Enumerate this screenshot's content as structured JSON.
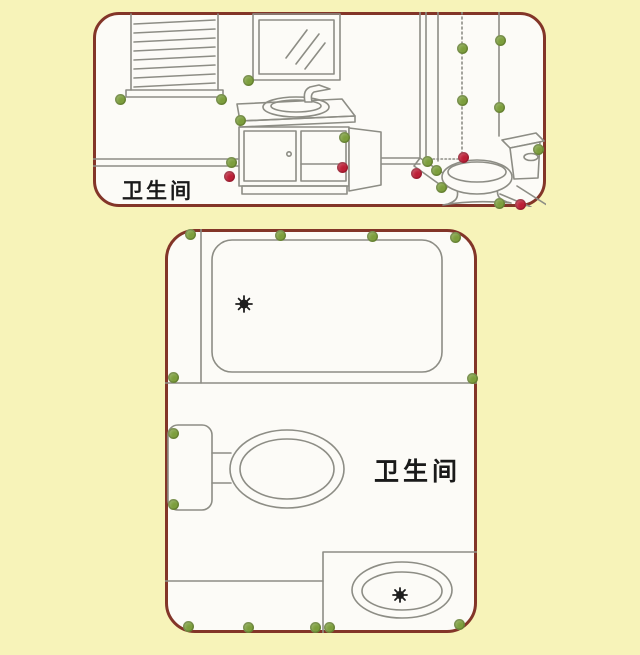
{
  "figure": {
    "background_color": "#F7F3B9",
    "panel_border_color": "#833528",
    "panel_fill_color": "#FCFBF7",
    "line_color": "#8D8D85",
    "point_colors": {
      "green": "#7C9E3C",
      "red": "#BC1F36"
    },
    "elevation": {
      "label": "卫生间",
      "points": [
        {
          "x": 27,
          "y": 87,
          "color": "green"
        },
        {
          "x": 128,
          "y": 87,
          "color": "green"
        },
        {
          "x": 155,
          "y": 68,
          "color": "green"
        },
        {
          "x": 147,
          "y": 108,
          "color": "green"
        },
        {
          "x": 138,
          "y": 150,
          "color": "green"
        },
        {
          "x": 251,
          "y": 125,
          "color": "green"
        },
        {
          "x": 369,
          "y": 36,
          "color": "green"
        },
        {
          "x": 407,
          "y": 28,
          "color": "green"
        },
        {
          "x": 369,
          "y": 88,
          "color": "green"
        },
        {
          "x": 406,
          "y": 95,
          "color": "green"
        },
        {
          "x": 334,
          "y": 149,
          "color": "green"
        },
        {
          "x": 343,
          "y": 158,
          "color": "green"
        },
        {
          "x": 348,
          "y": 175,
          "color": "green"
        },
        {
          "x": 445,
          "y": 137,
          "color": "green"
        },
        {
          "x": 406,
          "y": 191,
          "color": "green"
        },
        {
          "x": 136,
          "y": 164,
          "color": "red"
        },
        {
          "x": 249,
          "y": 155,
          "color": "red"
        },
        {
          "x": 370,
          "y": 145,
          "color": "red"
        },
        {
          "x": 323,
          "y": 161,
          "color": "red"
        },
        {
          "x": 427,
          "y": 192,
          "color": "red"
        }
      ]
    },
    "floorplan": {
      "label": "卫生间",
      "points": [
        {
          "x": 25,
          "y": 5,
          "color": "green"
        },
        {
          "x": 115,
          "y": 6,
          "color": "green"
        },
        {
          "x": 207,
          "y": 7,
          "color": "green"
        },
        {
          "x": 290,
          "y": 8,
          "color": "green"
        },
        {
          "x": 8,
          "y": 148,
          "color": "green"
        },
        {
          "x": 307,
          "y": 149,
          "color": "green"
        },
        {
          "x": 8,
          "y": 204,
          "color": "green"
        },
        {
          "x": 8,
          "y": 275,
          "color": "green"
        },
        {
          "x": 23,
          "y": 397,
          "color": "green"
        },
        {
          "x": 83,
          "y": 398,
          "color": "green"
        },
        {
          "x": 150,
          "y": 398,
          "color": "green"
        },
        {
          "x": 164,
          "y": 398,
          "color": "green"
        },
        {
          "x": 294,
          "y": 395,
          "color": "green"
        }
      ]
    }
  }
}
